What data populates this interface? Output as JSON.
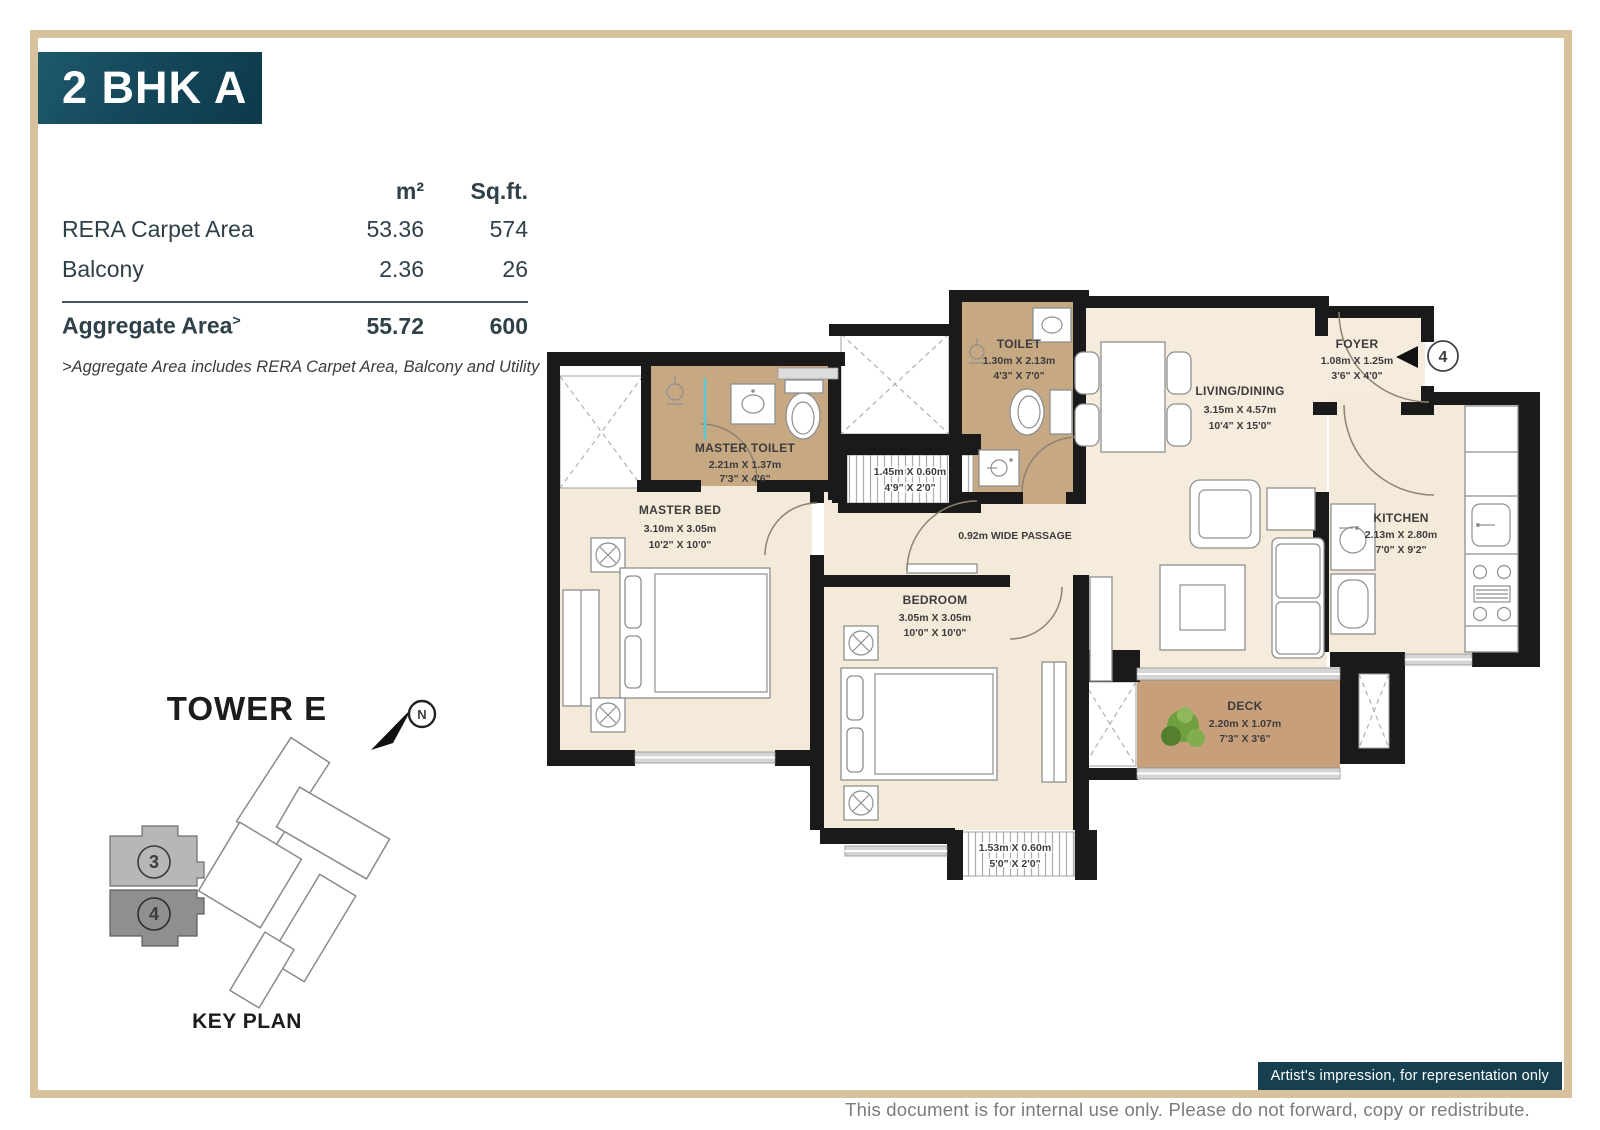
{
  "page": {
    "title": "2 BHK A",
    "badge": "Artist's impression, for representation only",
    "footer": "This document is for internal use only. Please do not forward, copy or redistribute."
  },
  "colors": {
    "title_bg": "#14485A",
    "badge_bg": "#16404F",
    "frame_border": "#D8C19D",
    "wall": "#1A1A1A",
    "floor": "#F4EADA",
    "wet_floor": "#C6A883",
    "deck_floor": "#C89F7B",
    "text": "#2F4049",
    "footer_text": "#7B7B7B",
    "glass_partition": "#5BC8D2"
  },
  "area_table": {
    "headers": {
      "col_m2": "m²",
      "col_sqft": "Sq.ft."
    },
    "rows": [
      {
        "label": "RERA Carpet Area",
        "m2": "53.36",
        "sqft": "574"
      },
      {
        "label": "Balcony",
        "m2": "2.36",
        "sqft": "26"
      },
      {
        "label": "Aggregate Area",
        "sup": ">",
        "m2": "55.72",
        "sqft": "600"
      }
    ],
    "note": ">Aggregate Area includes RERA Carpet Area, Balcony and Utility"
  },
  "keyplan": {
    "title": "TOWER E",
    "north_label": "N",
    "caption": "KEY PLAN",
    "units": [
      {
        "num": "3"
      },
      {
        "num": "4"
      }
    ]
  },
  "floorplan": {
    "unit_marker": "4",
    "passage_label": "0.92m WIDE PASSAGE",
    "rooms": {
      "master_toilet": {
        "name": "MASTER TOILET",
        "m": "2.21m X 1.37m",
        "ft": "7'3\" X 4'6\""
      },
      "toilet": {
        "name": "TOILET",
        "m": "1.30m X 2.13m",
        "ft": "4'3\" X 7'0\""
      },
      "living_dining": {
        "name": "LIVING/DINING",
        "m": "3.15m X 4.57m",
        "ft": "10'4\" X 15'0\""
      },
      "foyer": {
        "name": "FOYER",
        "m": "1.08m X 1.25m",
        "ft": "3'6\" X 4'0\""
      },
      "kitchen": {
        "name": "KITCHEN",
        "m": "2.13m X 2.80m",
        "ft": "7'0\" X 9'2\""
      },
      "master_bed": {
        "name": "MASTER BED",
        "m": "3.10m X 3.05m",
        "ft": "10'2\" X 10'0\""
      },
      "bedroom": {
        "name": "BEDROOM",
        "m": "3.05m X 3.05m",
        "ft": "10'0\" X 10'0\""
      },
      "deck": {
        "name": "DECK",
        "m": "2.20m X 1.07m",
        "ft": "7'3\" X 3'6\""
      }
    },
    "ledges": [
      {
        "m": "1.45m X 0.60m",
        "ft": "4'9\" X 2'0\""
      },
      {
        "m": "1.53m X 0.60m",
        "ft": "5'0\" X 2'0\""
      }
    ]
  }
}
